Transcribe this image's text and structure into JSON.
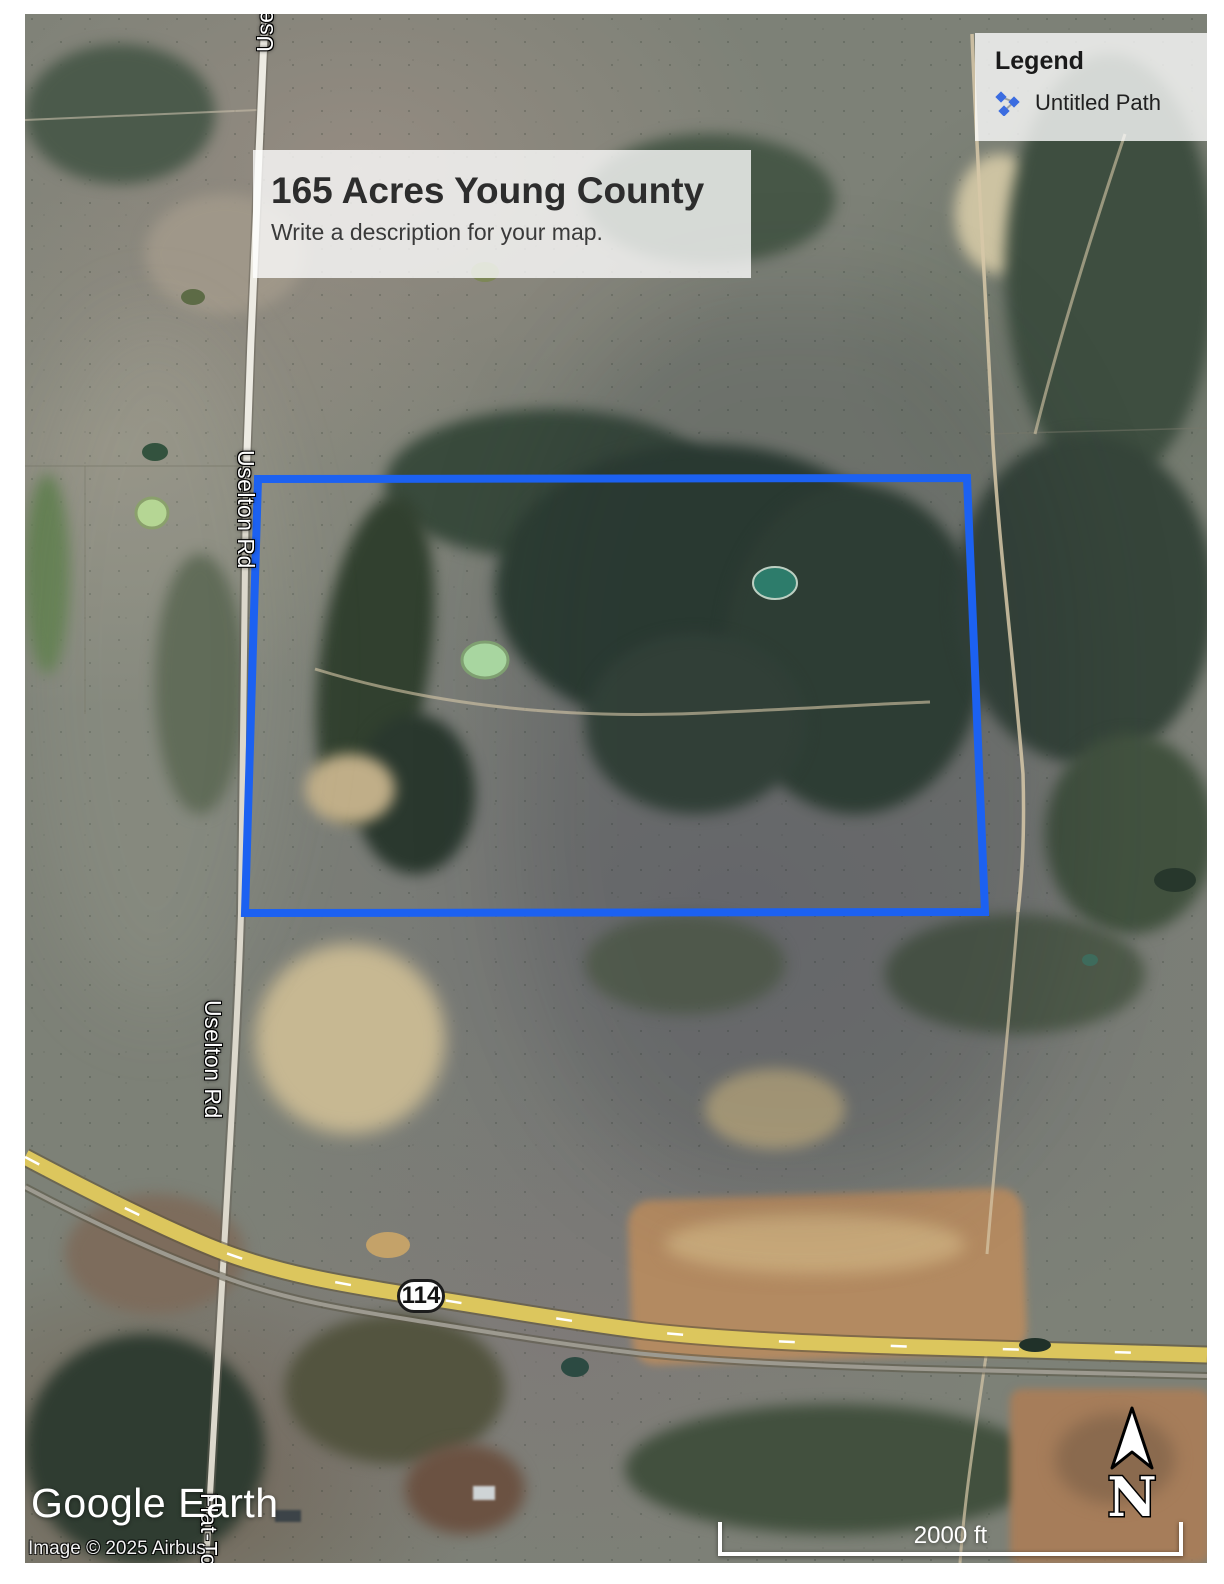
{
  "map": {
    "title_box": {
      "title": "165 Acres Young County",
      "description": "Write a description for your map."
    },
    "legend": {
      "heading": "Legend",
      "items": [
        {
          "icon": "path-icon",
          "label": "Untitled Path"
        }
      ]
    },
    "road_labels": [
      {
        "id": "uselton-top",
        "label": "Uselton Rd"
      },
      {
        "id": "uselton-upper",
        "label": "Uselton Rd"
      },
      {
        "id": "uselton-lower",
        "label": "Uselton Rd"
      },
      {
        "id": "flat-top",
        "label": "Flat-Top Rd"
      }
    ],
    "highway_shield": "114",
    "scale_bar_label": "2000 ft",
    "north_label": "N",
    "attribution": {
      "logo": "Google Earth",
      "copyright": "Image © 2025 Airbus"
    },
    "colors": {
      "boundary_blue": "#1c61f1",
      "highway_yellow": "#dcc65d",
      "panel_bg": "rgba(255,255,255,0.78)"
    }
  }
}
